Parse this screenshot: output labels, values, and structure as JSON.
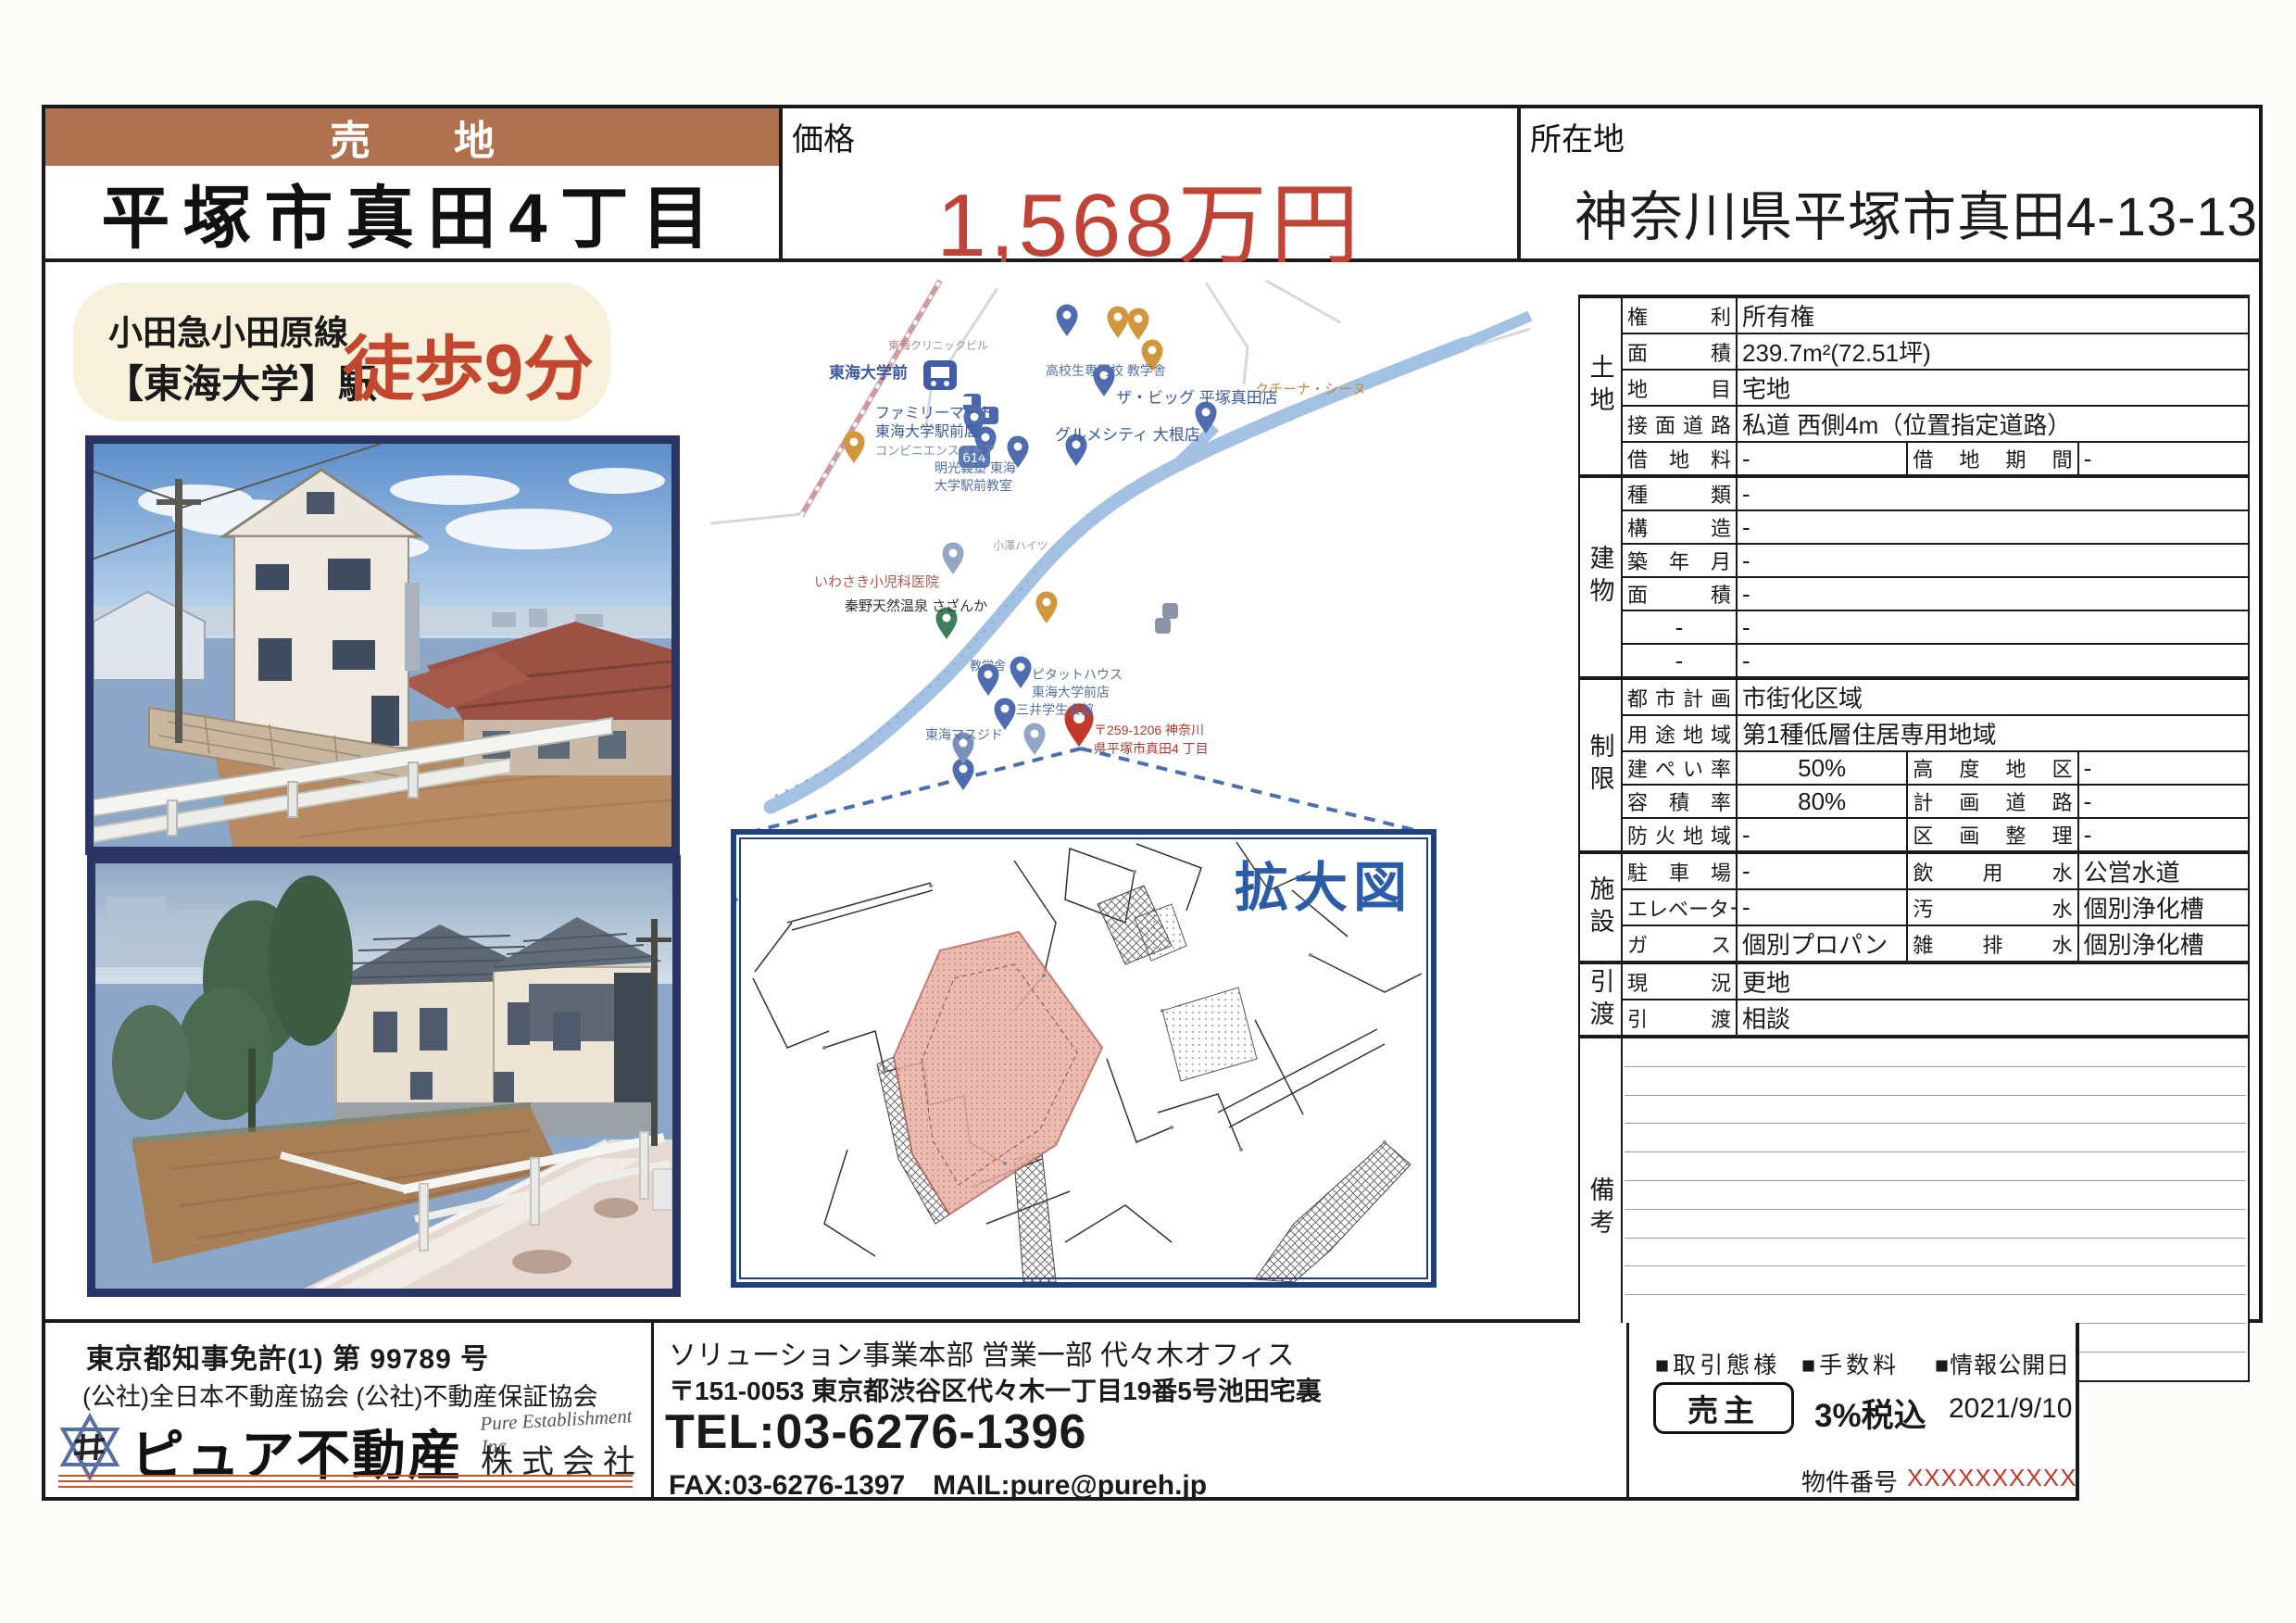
{
  "page": {
    "badge": "売地",
    "title": "平塚市真田4丁目"
  },
  "price": {
    "label": "価格",
    "value": "1,568万円"
  },
  "location": {
    "label": "所在地",
    "value": "神奈川県平塚市真田4-13-13"
  },
  "access": {
    "line1": "小田急小田原線",
    "line2": "【東海大学】駅",
    "walk": "徒歩9分"
  },
  "map": {
    "labels": [
      "東海大学前",
      "ファミリーマート",
      "東海大学駅前店",
      "コンビニエンスストア",
      "高校生専門校 教学舎",
      "ザ・ビッグ 平塚真田店",
      "グルメシティ 大根店",
      "クチーナ・シーヌ",
      "明光義塾 東海",
      "大学駅前教室",
      "いわさき小児科医院",
      "秦野天然温泉 さざんか",
      "東海クリニックビル",
      "教学舎",
      "ピタットハウス",
      "東海大学前店",
      "三井学生会館",
      "東海マスジド",
      "小澤ハイツ",
      "614",
      "〒259-1206 神奈川",
      "県平塚市真田4 丁目"
    ]
  },
  "enlarged": {
    "label": "拡大図"
  },
  "spec": {
    "land": {
      "group": "土地",
      "rows": [
        {
          "l": "権利",
          "v": "所有権"
        },
        {
          "l": "面積",
          "v": "239.7m²(72.51坪)"
        },
        {
          "l": "地目",
          "v": "宅地"
        },
        {
          "l": "接面道路",
          "v": "私道 西側4m（位置指定道路）"
        },
        {
          "l": "借地料",
          "v": "-",
          "l2": "借地期間",
          "v2": "-"
        }
      ]
    },
    "building": {
      "group": "建物",
      "rows": [
        {
          "l": "種類",
          "v": "-"
        },
        {
          "l": "構造",
          "v": "-"
        },
        {
          "l": "築年月",
          "v": "-"
        },
        {
          "l": "面積",
          "v": "-"
        },
        {
          "l": "-",
          "v": "-"
        },
        {
          "l": "-",
          "v": "-"
        }
      ]
    },
    "restriction": {
      "group": "制限",
      "rows": [
        {
          "l": "都市計画",
          "v": "市街化区域"
        },
        {
          "l": "用途地域",
          "v": "第1種低層住居専用地域"
        },
        {
          "l": "建ぺい率",
          "v": "50%",
          "l2": "高度地区",
          "v2": "-"
        },
        {
          "l": "容積率",
          "v": "80%",
          "l2": "計画道路",
          "v2": "-"
        },
        {
          "l": "防火地域",
          "v": "-",
          "l2": "区画整理",
          "v2": "-"
        }
      ]
    },
    "facility": {
      "group": "施設",
      "rows": [
        {
          "l": "駐車場",
          "v": "-",
          "l2": "飲用水",
          "v2": "公営水道"
        },
        {
          "l": "エレベーター",
          "v": "-",
          "l2": "汚水",
          "v2": "個別浄化槽"
        },
        {
          "l": "ガス",
          "v": "個別プロパン",
          "l2": "雑排水",
          "v2": "個別浄化槽"
        }
      ]
    },
    "handover": {
      "group": "引渡",
      "rows": [
        {
          "l": "現況",
          "v": "更地"
        },
        {
          "l": "引渡",
          "v": "相談"
        }
      ]
    },
    "remarks": {
      "group": "備考"
    }
  },
  "footer": {
    "license": "東京都知事免許(1) 第 99789 号",
    "associations": "(公社)全日本不動産協会 (公社)不動産保証協会",
    "company_name": "ピュア不動産",
    "company_script": "Pure Establishment Inc",
    "company_suffix": "株式会社",
    "office": "ソリューション事業本部 営業一部 代々木オフィス",
    "address": "〒151-0053 東京都渋谷区代々木一丁目19番5号池田宅裏",
    "tel": "TEL:03-6276-1396",
    "fax_mail": "FAX:03-6276-1397　MAIL:pure@pureh.jp",
    "deal_type_label": "■取引態様",
    "deal_type_value": "売主",
    "fee_label": "■手数料",
    "fee_value": "3%税込",
    "publish_label": "■情報公開日",
    "publish_value": "2021/9/10",
    "property_no_label": "物件番号",
    "property_no_value": "XXXXXXXXXX"
  }
}
